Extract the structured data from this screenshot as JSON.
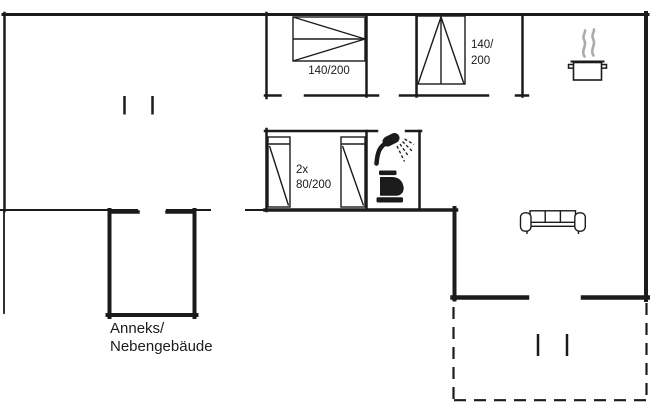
{
  "document": {
    "type": "floor-plan"
  },
  "colors": {
    "line": "#1b1b1b",
    "steam": "#ababab",
    "background": "#ffffff"
  },
  "labels": {
    "bed_double_top": "140/200",
    "bed_double_right_line1": "140/",
    "bed_double_right_line2": "200",
    "bed_twin_line1": "2x",
    "bed_twin_line2": "80/200",
    "annex_line1": "Anneks/",
    "annex_line2": "Nebengebäude"
  },
  "icons": {
    "shower": "shower-icon",
    "toilet": "toilet-icon",
    "cooking_pot": "cooking-pot-icon",
    "sofa": "sofa-icon",
    "window_ticks": "window-tick-marks",
    "terrace": "terrace-dashed-outline"
  }
}
